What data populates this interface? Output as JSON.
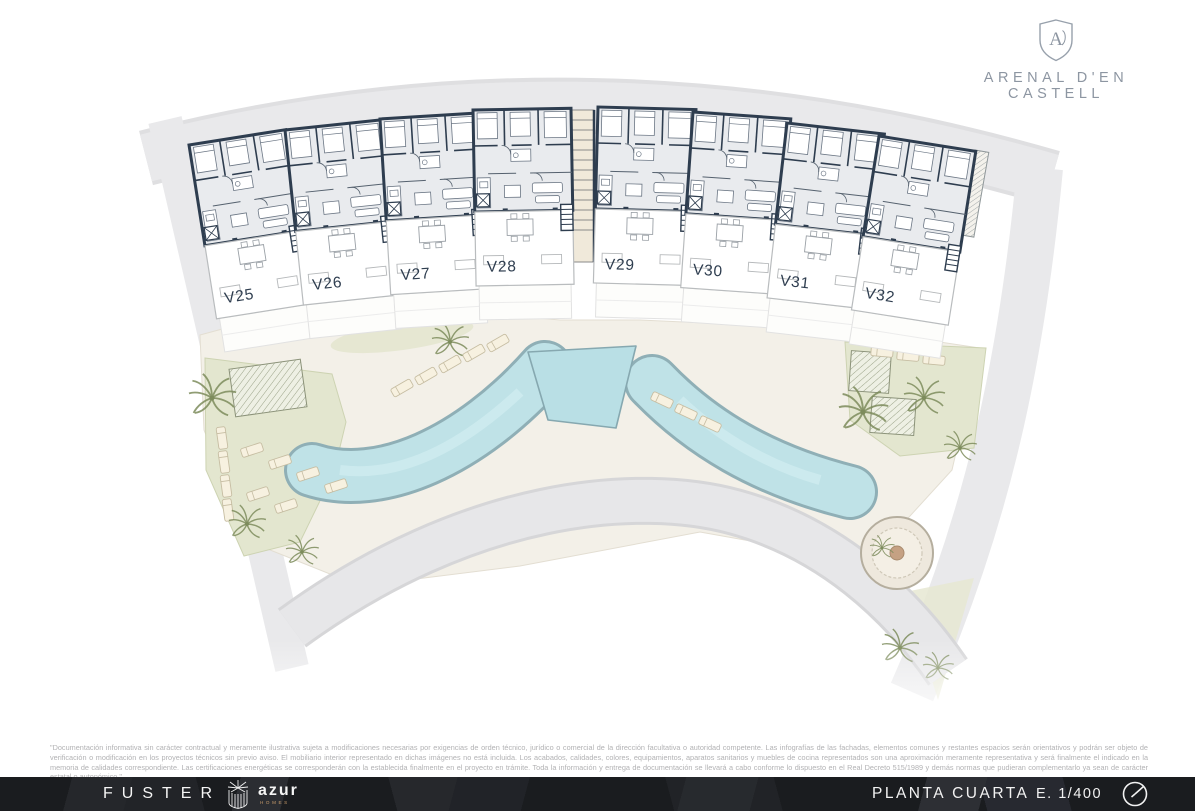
{
  "logo": {
    "name": "ARENAL D'EN CASTELL",
    "monogram": "A"
  },
  "plan": {
    "unit_labels": [
      "V25",
      "V26",
      "V27",
      "V28",
      "V29",
      "V30",
      "V31",
      "V32"
    ]
  },
  "disclaimer": {
    "text": "\"Documentación informativa sin carácter contractual y meramente ilustrativa sujeta a modificaciones necesarias por exigencias de orden técnico, jurídico o comercial de la dirección facultativa o autoridad competente. Las infografías de las fachadas, elementos comunes y restantes espacios serán orientativos y podrán ser objeto de verificación o modificación en los proyectos técnicos sin previo aviso. El mobiliario interior representado en dichas imágenes no está incluida. Los acabados, calidades, colores, equipamientos, aparatos sanitarios y muebles de cocina representados son una aproximación meramente representativa y será finalmente el indicado en la memoria de calidades correspondiente. Las certificaciones energéticas se corresponderán con la establecida finalmente en el proyecto en trámite. Toda la información y entrega de documentación se llevará a cabo conforme lo dispuesto en el Real Decreto 515/1989 y demás normas que pudieran complementarlo ya sean de carácter estatal o autonómico.\""
  },
  "footer": {
    "brand_fuster": "FUSTER",
    "brand_azur": "azur",
    "brand_azur_sub": "HOMES",
    "floor_label": "PLANTA CUARTA",
    "scale_label": "E. 1/400"
  },
  "colors": {
    "wall_navy": "#2e3d4f",
    "interior_fill": "#e9ebee",
    "pool_cyan": "#b9dfe5",
    "pool_edge": "#86a8b0",
    "deck_beige": "#f3f0e8",
    "garden_green": "#e3e6cf",
    "site_gray": "#e9e9eb",
    "footer_bg": "#1b1d20",
    "logo_gray": "#8d96a2",
    "homes_accent": "#c99c6b"
  }
}
